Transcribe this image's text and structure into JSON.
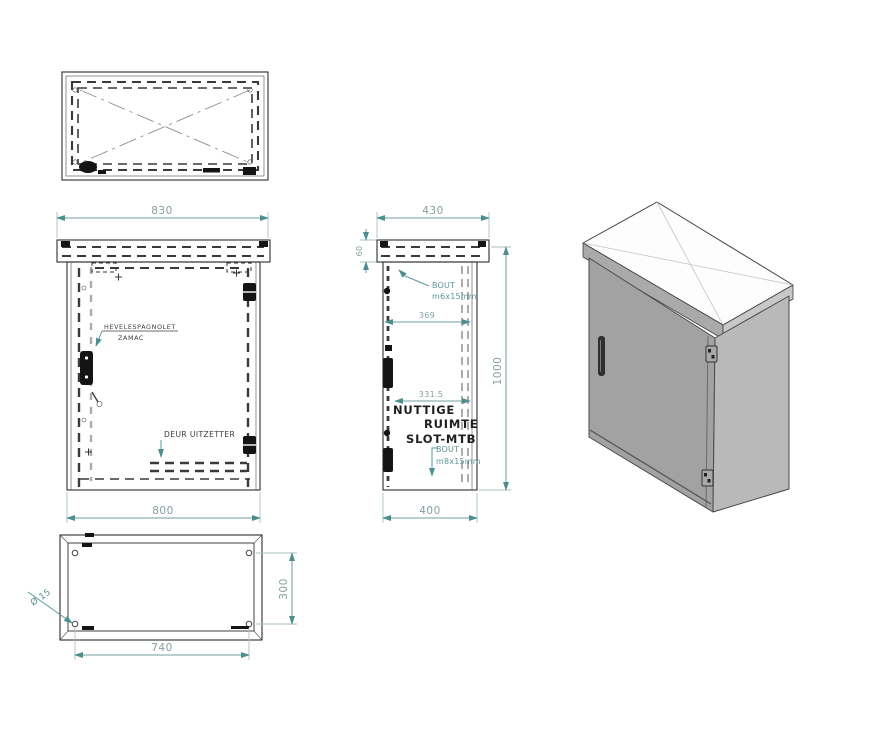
{
  "title": "cabinet-technical-drawing",
  "colors": {
    "background": "#ffffff",
    "drawing_line": "#2e2e2e",
    "dashed_door_line": "#ababab",
    "dimension_line": "#6f9b9c",
    "dimension_text": "#849e9e",
    "label_text": "#3c3c3c",
    "note_text": "#1f1f1f",
    "iso_top_face": "#fdfdfd",
    "iso_front_face": "#a2a2a2",
    "iso_right_face": "#b9b9b9",
    "iso_lid_front_band": "#aaaaaa",
    "iso_lid_right_band": "#c8c8c8"
  },
  "views": {
    "front": {
      "dim_width_top": "830",
      "dim_width_bottom": "800",
      "lock_label_line1": "HEVELESPAGNOLET",
      "lock_label_line2": "ZAMAC",
      "door_label": "DEUR UITZETTER"
    },
    "side": {
      "dim_depth_top": "430",
      "dim_lid_height": "60",
      "bolt_top_line1": "BOUT",
      "bolt_top_line2": "m6x15mm",
      "dim_inner_depth": "369",
      "dim_slot_depth": "331.5",
      "dim_height": "1000",
      "note_line1": "NUTTIGE",
      "note_line2": "RUIMTE",
      "note_line3": "SLOT-MTB",
      "bolt_bottom_line1": "BOUT",
      "bolt_bottom_line2": "m8x15mm",
      "dim_depth_bottom": "400"
    },
    "bottom": {
      "dim_hole_width": "740",
      "dim_hole_depth": "300",
      "hole_diameter_label": "Ø 15"
    }
  }
}
